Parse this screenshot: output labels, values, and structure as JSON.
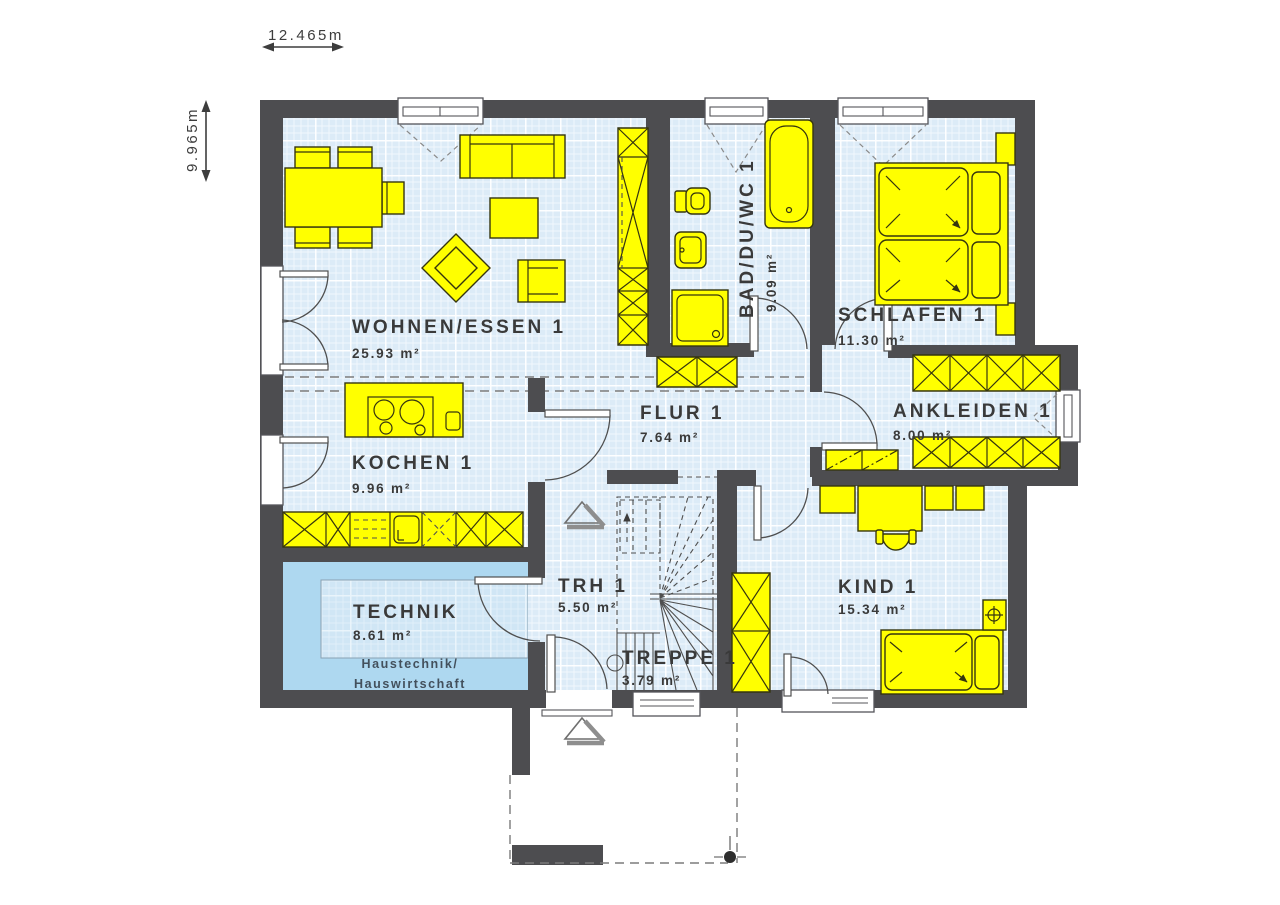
{
  "plan": {
    "dimension_width": "12.465m",
    "dimension_height": "9.965m",
    "rooms": {
      "wohnen_essen": {
        "name": "WOHNEN/ESSEN 1",
        "area": "25.93 m²"
      },
      "kochen": {
        "name": "KOCHEN 1",
        "area": "9.96 m²"
      },
      "bad": {
        "name": "BAD/DU/WC 1",
        "area": "9.09 m²"
      },
      "schlafen": {
        "name": "SCHLAFEN 1",
        "area": "11.30 m²"
      },
      "flur": {
        "name": "FLUR 1",
        "area": "7.64 m²"
      },
      "ankleiden": {
        "name": "ANKLEIDEN 1",
        "area": "8.00 m²"
      },
      "trh": {
        "name": "TRH 1",
        "area": "5.50 m²"
      },
      "treppe": {
        "name": "TREPPE 1",
        "area": "3.79 m²"
      },
      "kind": {
        "name": "KIND 1",
        "area": "15.34 m²"
      },
      "technik": {
        "name": "TECHNIK",
        "area": "8.61 m²",
        "note1": "Haustechnik/",
        "note2": "Hauswirtschaft"
      }
    },
    "colors": {
      "wall": "#4d4d50",
      "floor": "#dcebf7",
      "furniture": "#ffff00",
      "technik_room": "#aed8f0"
    }
  }
}
